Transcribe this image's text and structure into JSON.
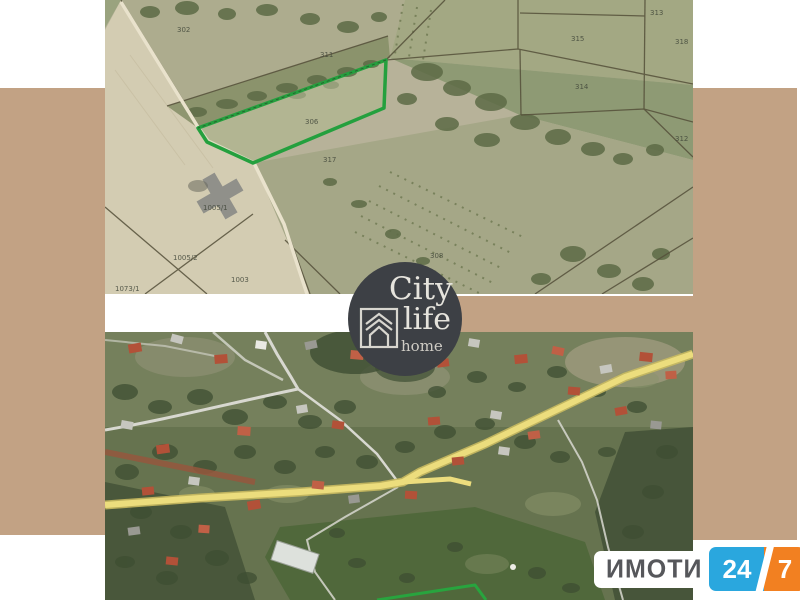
{
  "background": {
    "page_color": "#ffffff",
    "panel_color": "#c2a284"
  },
  "branding": {
    "city_life": {
      "word1": "City",
      "word2": "life",
      "word3": "home"
    },
    "imoti": {
      "name": "ИМОТИ",
      "number_left": "24",
      "number_right": "7"
    }
  },
  "top_map": {
    "description": "cadastral satellite view with green highlighted parcel",
    "highlight_color": "#24a03e",
    "labels": [
      "302",
      "313",
      "311",
      "315",
      "314",
      "318",
      "312",
      "306",
      "317",
      "308",
      "1005/1",
      "1005/2",
      "1003",
      "1073/1"
    ]
  },
  "bottom_map": {
    "description": "village satellite view with yellow road and green parcel corner",
    "highlight_color": "#28a43e",
    "road_color": "#ecdd7d"
  }
}
